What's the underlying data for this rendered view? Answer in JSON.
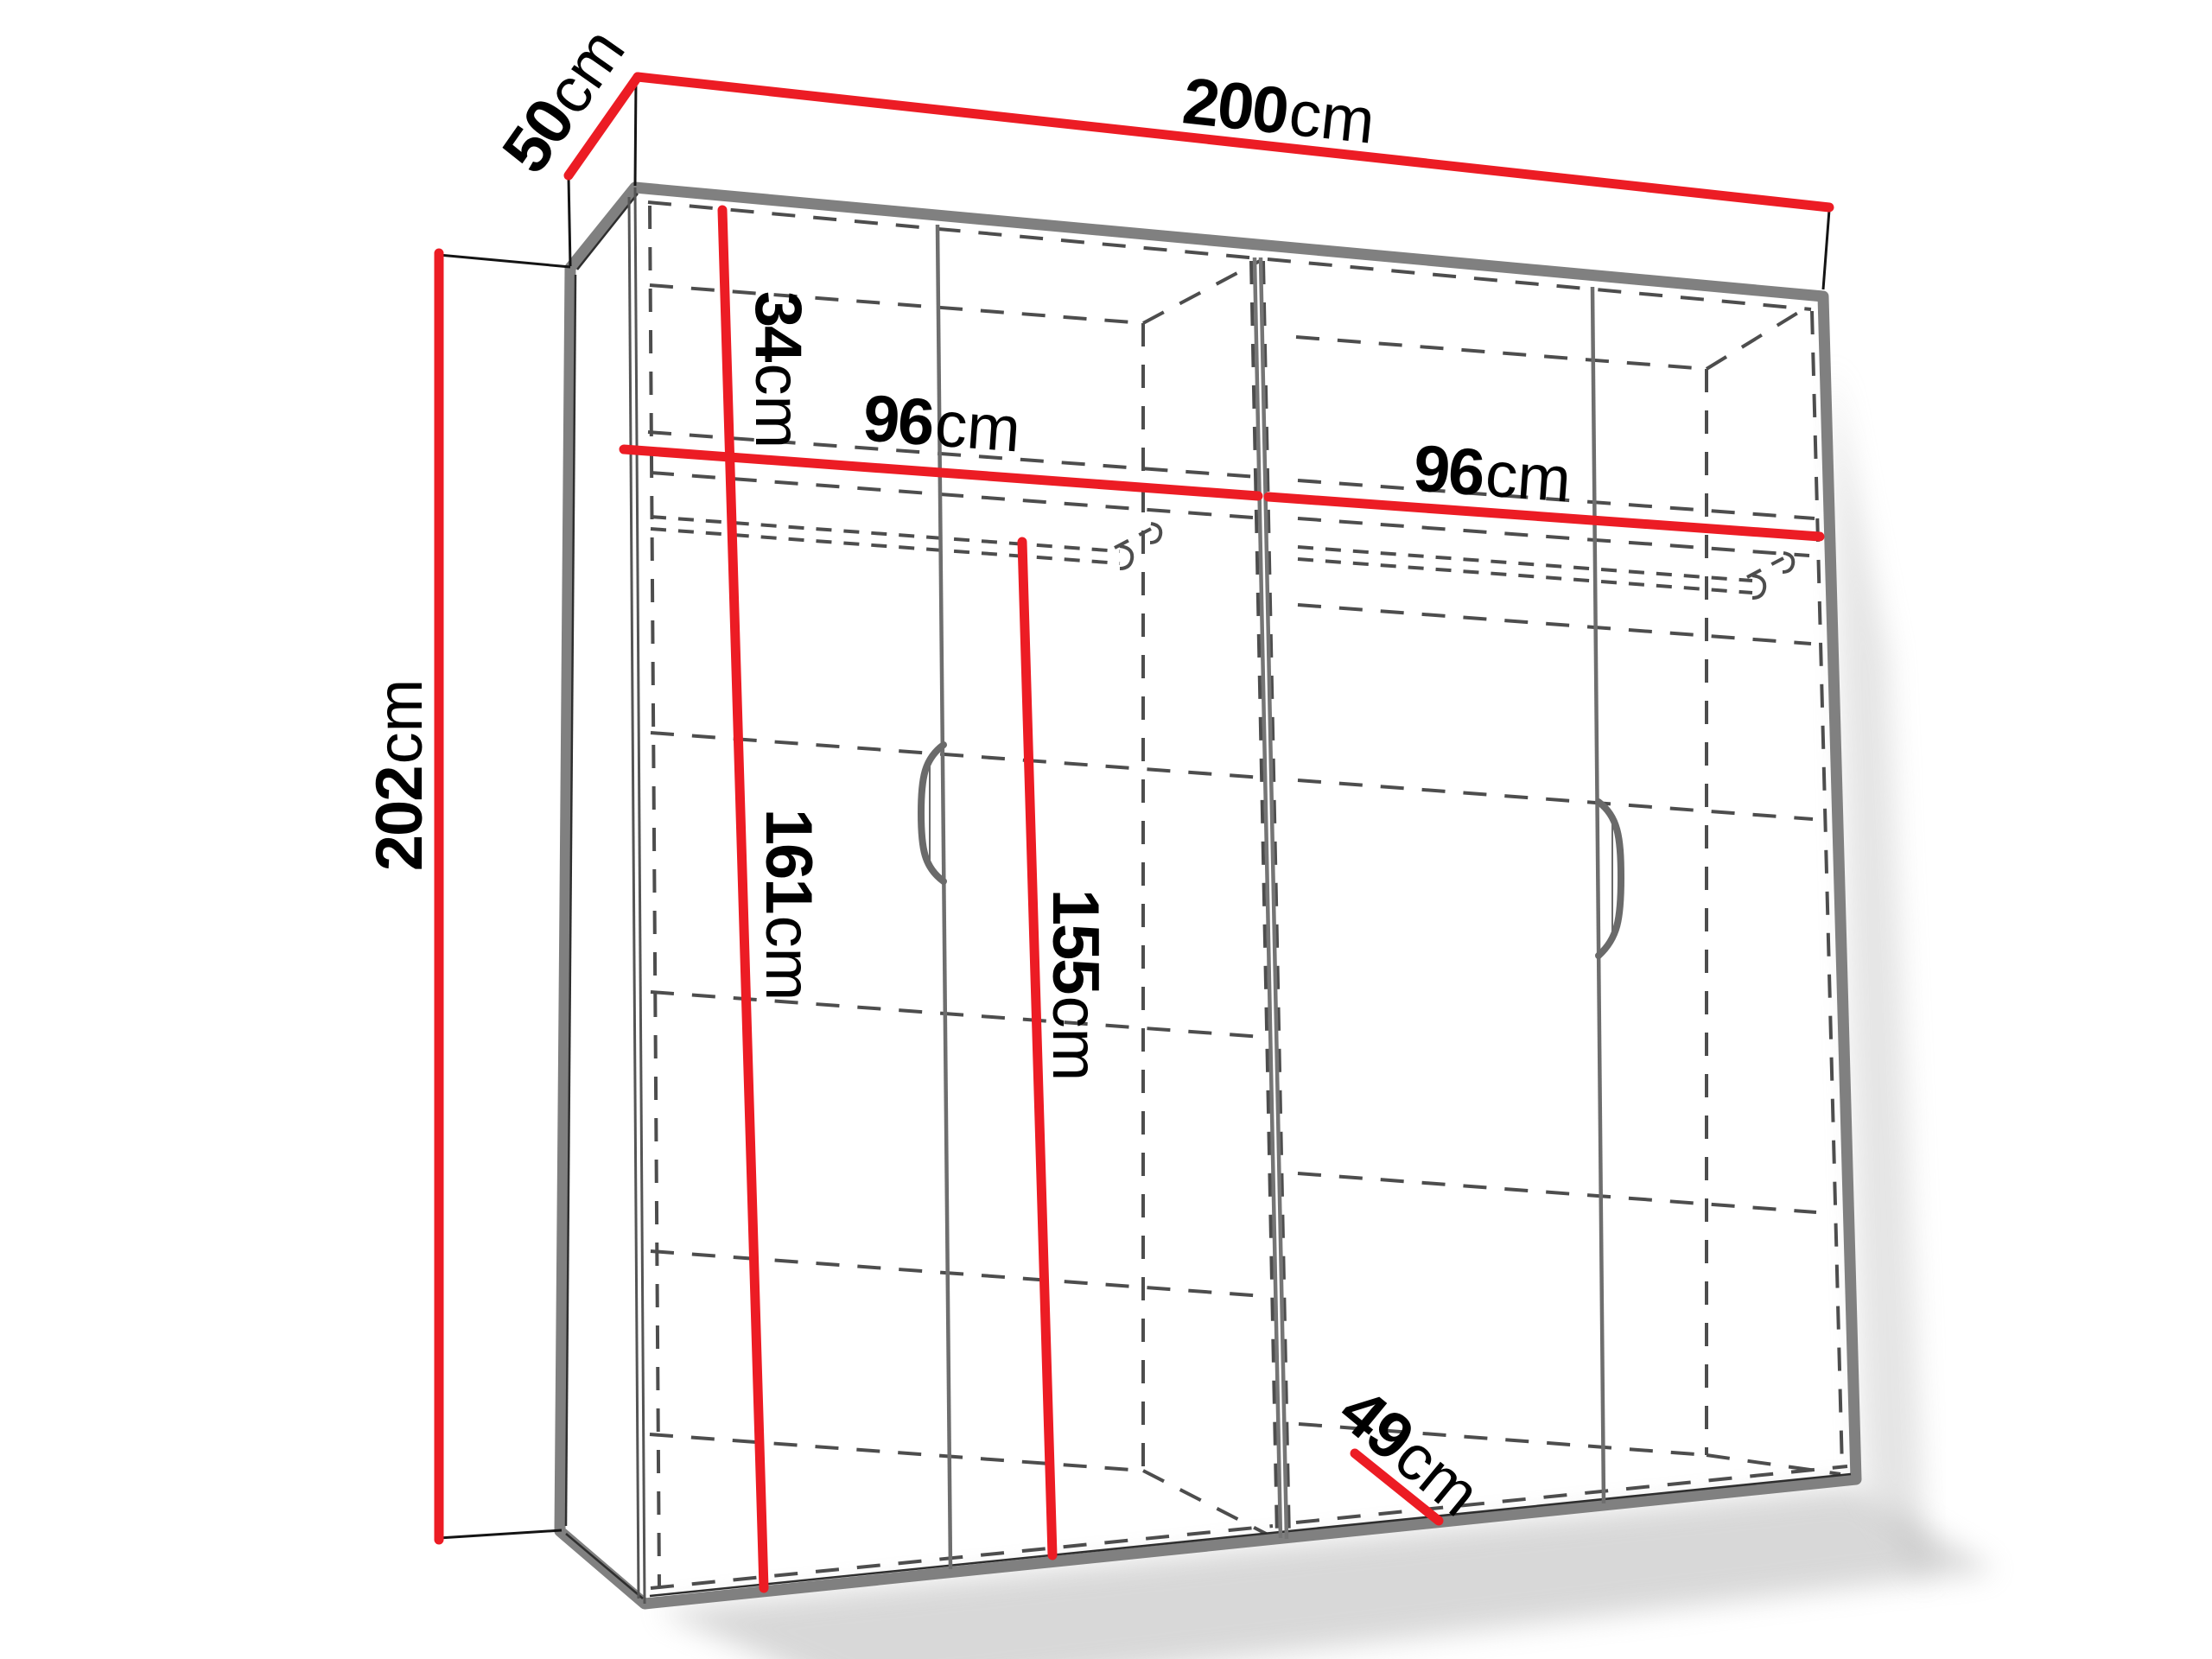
{
  "title": "Wardrobe technical dimensions diagram",
  "unit": "cm",
  "colors": {
    "dimension_red": "#ec1c24",
    "panel_gray": "#808080",
    "dash_gray": "#4d4d4d",
    "line_black": "#141414",
    "handle_gray": "#6a6a6a",
    "background": "#ffffff"
  },
  "dimensions": {
    "width": {
      "value": "200",
      "unit": "cm"
    },
    "depth": {
      "value": "50",
      "unit": "cm"
    },
    "height": {
      "value": "202",
      "unit": "cm"
    },
    "top_shelf_height": {
      "value": "34",
      "unit": "cm"
    },
    "left_compartment_width": {
      "value": "96",
      "unit": "cm"
    },
    "right_compartment_width": {
      "value": "96",
      "unit": "cm"
    },
    "left_interior_height": {
      "value": "161",
      "unit": "cm"
    },
    "rail_clearance_height": {
      "value": "155",
      "unit": "cm"
    },
    "interior_depth": {
      "value": "49",
      "unit": "cm"
    }
  }
}
